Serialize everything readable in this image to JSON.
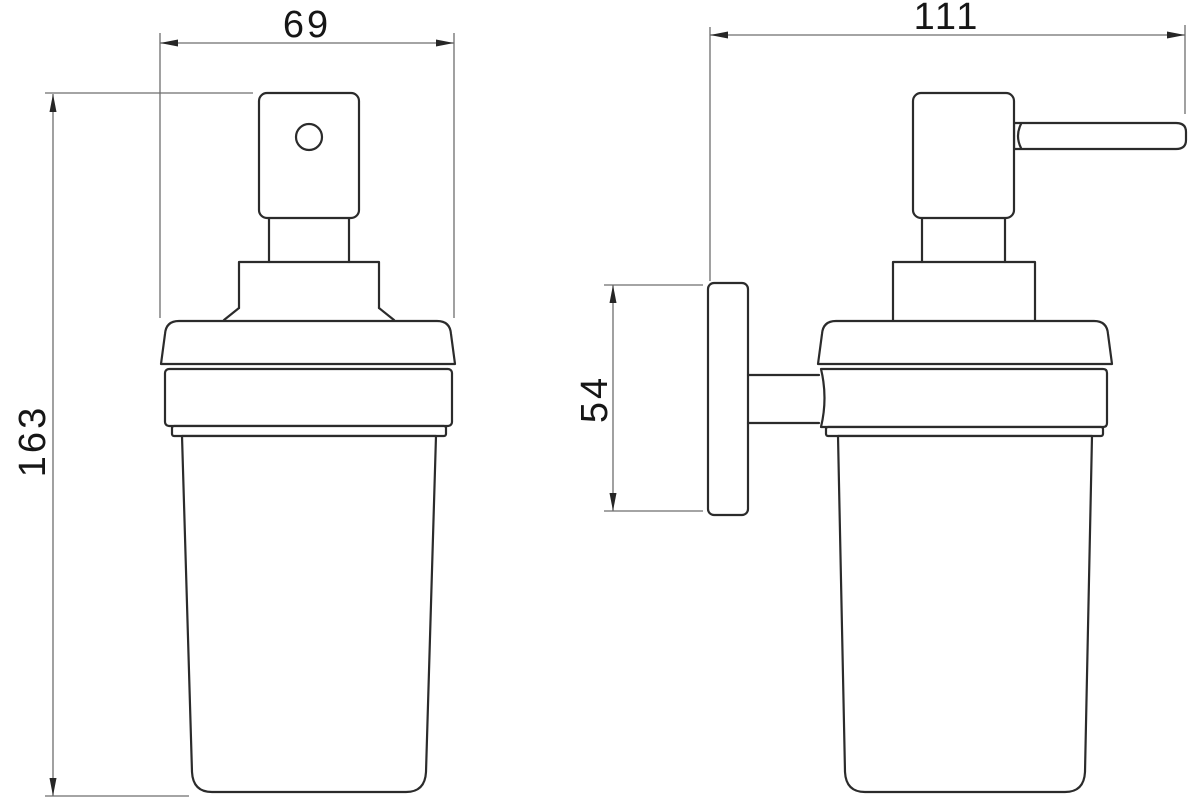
{
  "drawing": {
    "dimension_labels": {
      "front_width": "69",
      "overall_height": "163",
      "side_depth": "111",
      "wall_plate_height": "54"
    },
    "colors": {
      "object_line": "#2b2b2b",
      "dimension_line": "#6e6e6e",
      "background": "#ffffff"
    }
  }
}
